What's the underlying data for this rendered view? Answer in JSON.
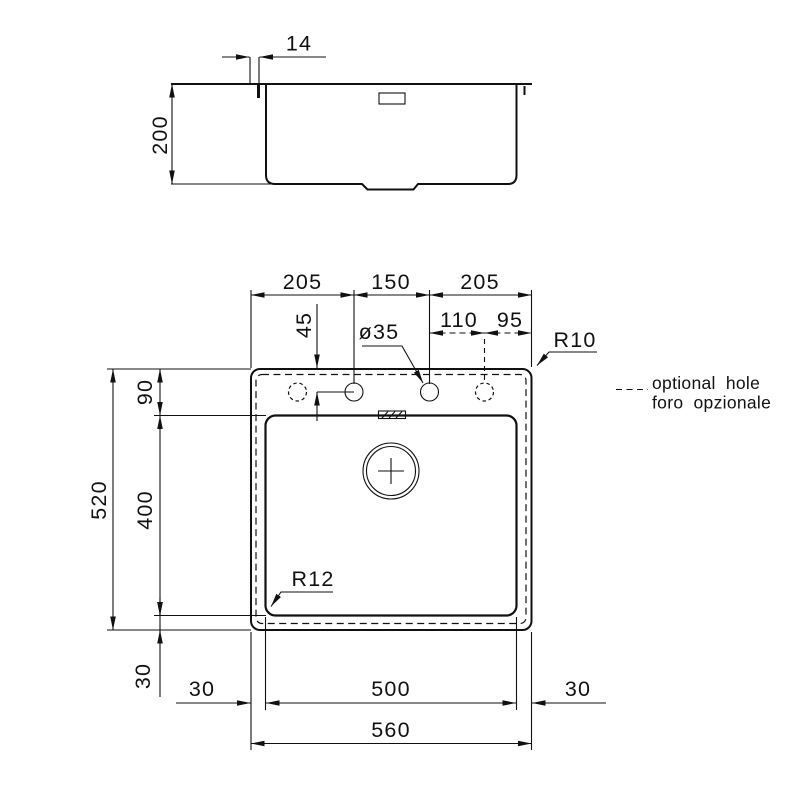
{
  "side_view": {
    "dim_tap_hole_offset": "14",
    "dim_depth": "200"
  },
  "plan_view": {
    "dim_top_left": "205",
    "dim_top_middle": "150",
    "dim_top_right": "205",
    "dim_hole_spacing_left": "110",
    "dim_hole_spacing_right": "95",
    "dim_hole_to_bowl": "45",
    "label_hole_diameter": "ø35",
    "label_radius_outer": "R10",
    "label_radius_bowl": "R12",
    "dim_total_height": "520",
    "dim_rim_top": "90",
    "dim_bowl_height": "400",
    "dim_rim_bottom": "30",
    "dim_bottom_left": "30",
    "dim_bowl_width": "500",
    "dim_bottom_right": "30",
    "dim_total_width": "560"
  },
  "legend": {
    "line1": "optional hole",
    "line2": "foro opzionale"
  },
  "colors": {
    "line": "#111111",
    "background": "#ffffff"
  }
}
